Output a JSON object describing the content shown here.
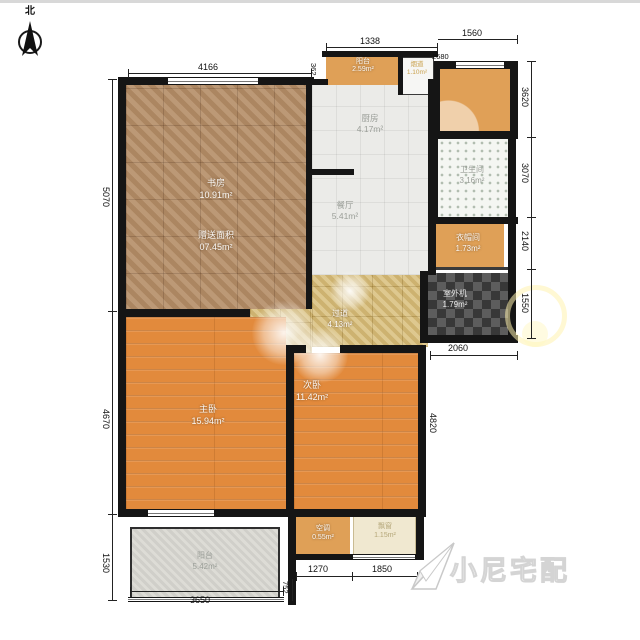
{
  "compass": {
    "label": "北"
  },
  "watermark": {
    "text": "小尼宅配"
  },
  "rooms": {
    "study": {
      "name": "书房",
      "area": "10.91m²"
    },
    "study_bonus": {
      "name": "赠送面积",
      "area": "07.45m²"
    },
    "kitchen": {
      "name": "厨房",
      "area": "4.17m²"
    },
    "dining": {
      "name": "餐厅",
      "area": "5.41m²"
    },
    "balcony_top": {
      "name": "阳台",
      "area": "2.59m²"
    },
    "duct": {
      "name": "烟道",
      "area": "1.10m²"
    },
    "bathroom": {
      "name": "卫生间",
      "area": "3.16m²"
    },
    "cloakroom": {
      "name": "衣帽间",
      "area": "1.73m²"
    },
    "terrace": {
      "name": "室外机",
      "area": "1.79m²"
    },
    "hallway": {
      "name": "过道",
      "area": "4.13m²"
    },
    "master": {
      "name": "主卧",
      "area": "15.94m²"
    },
    "second": {
      "name": "次卧",
      "area": "11.42m²"
    },
    "balcony_bottom": {
      "name": "阳台",
      "area": "5.42m²"
    },
    "ac": {
      "name": "空调",
      "area": "0.55m²"
    },
    "bay": {
      "name": "飘窗",
      "area": "1.15m²"
    }
  },
  "dims": {
    "top_study": "4166",
    "top_mid": "1338",
    "top_right": "1560",
    "top_right_inner": "2680",
    "top_small": "362",
    "right_1": "3620",
    "right_2": "3070",
    "right_3": "2140",
    "right_4": "1550",
    "mid_right": "2060",
    "bed2_height": "4820",
    "left_1": "5070",
    "left_2": "4670",
    "left_3": "1530",
    "bottom_balcony": "3650",
    "bottom_small": "752",
    "bottom_1": "1270",
    "bottom_2": "1850"
  }
}
